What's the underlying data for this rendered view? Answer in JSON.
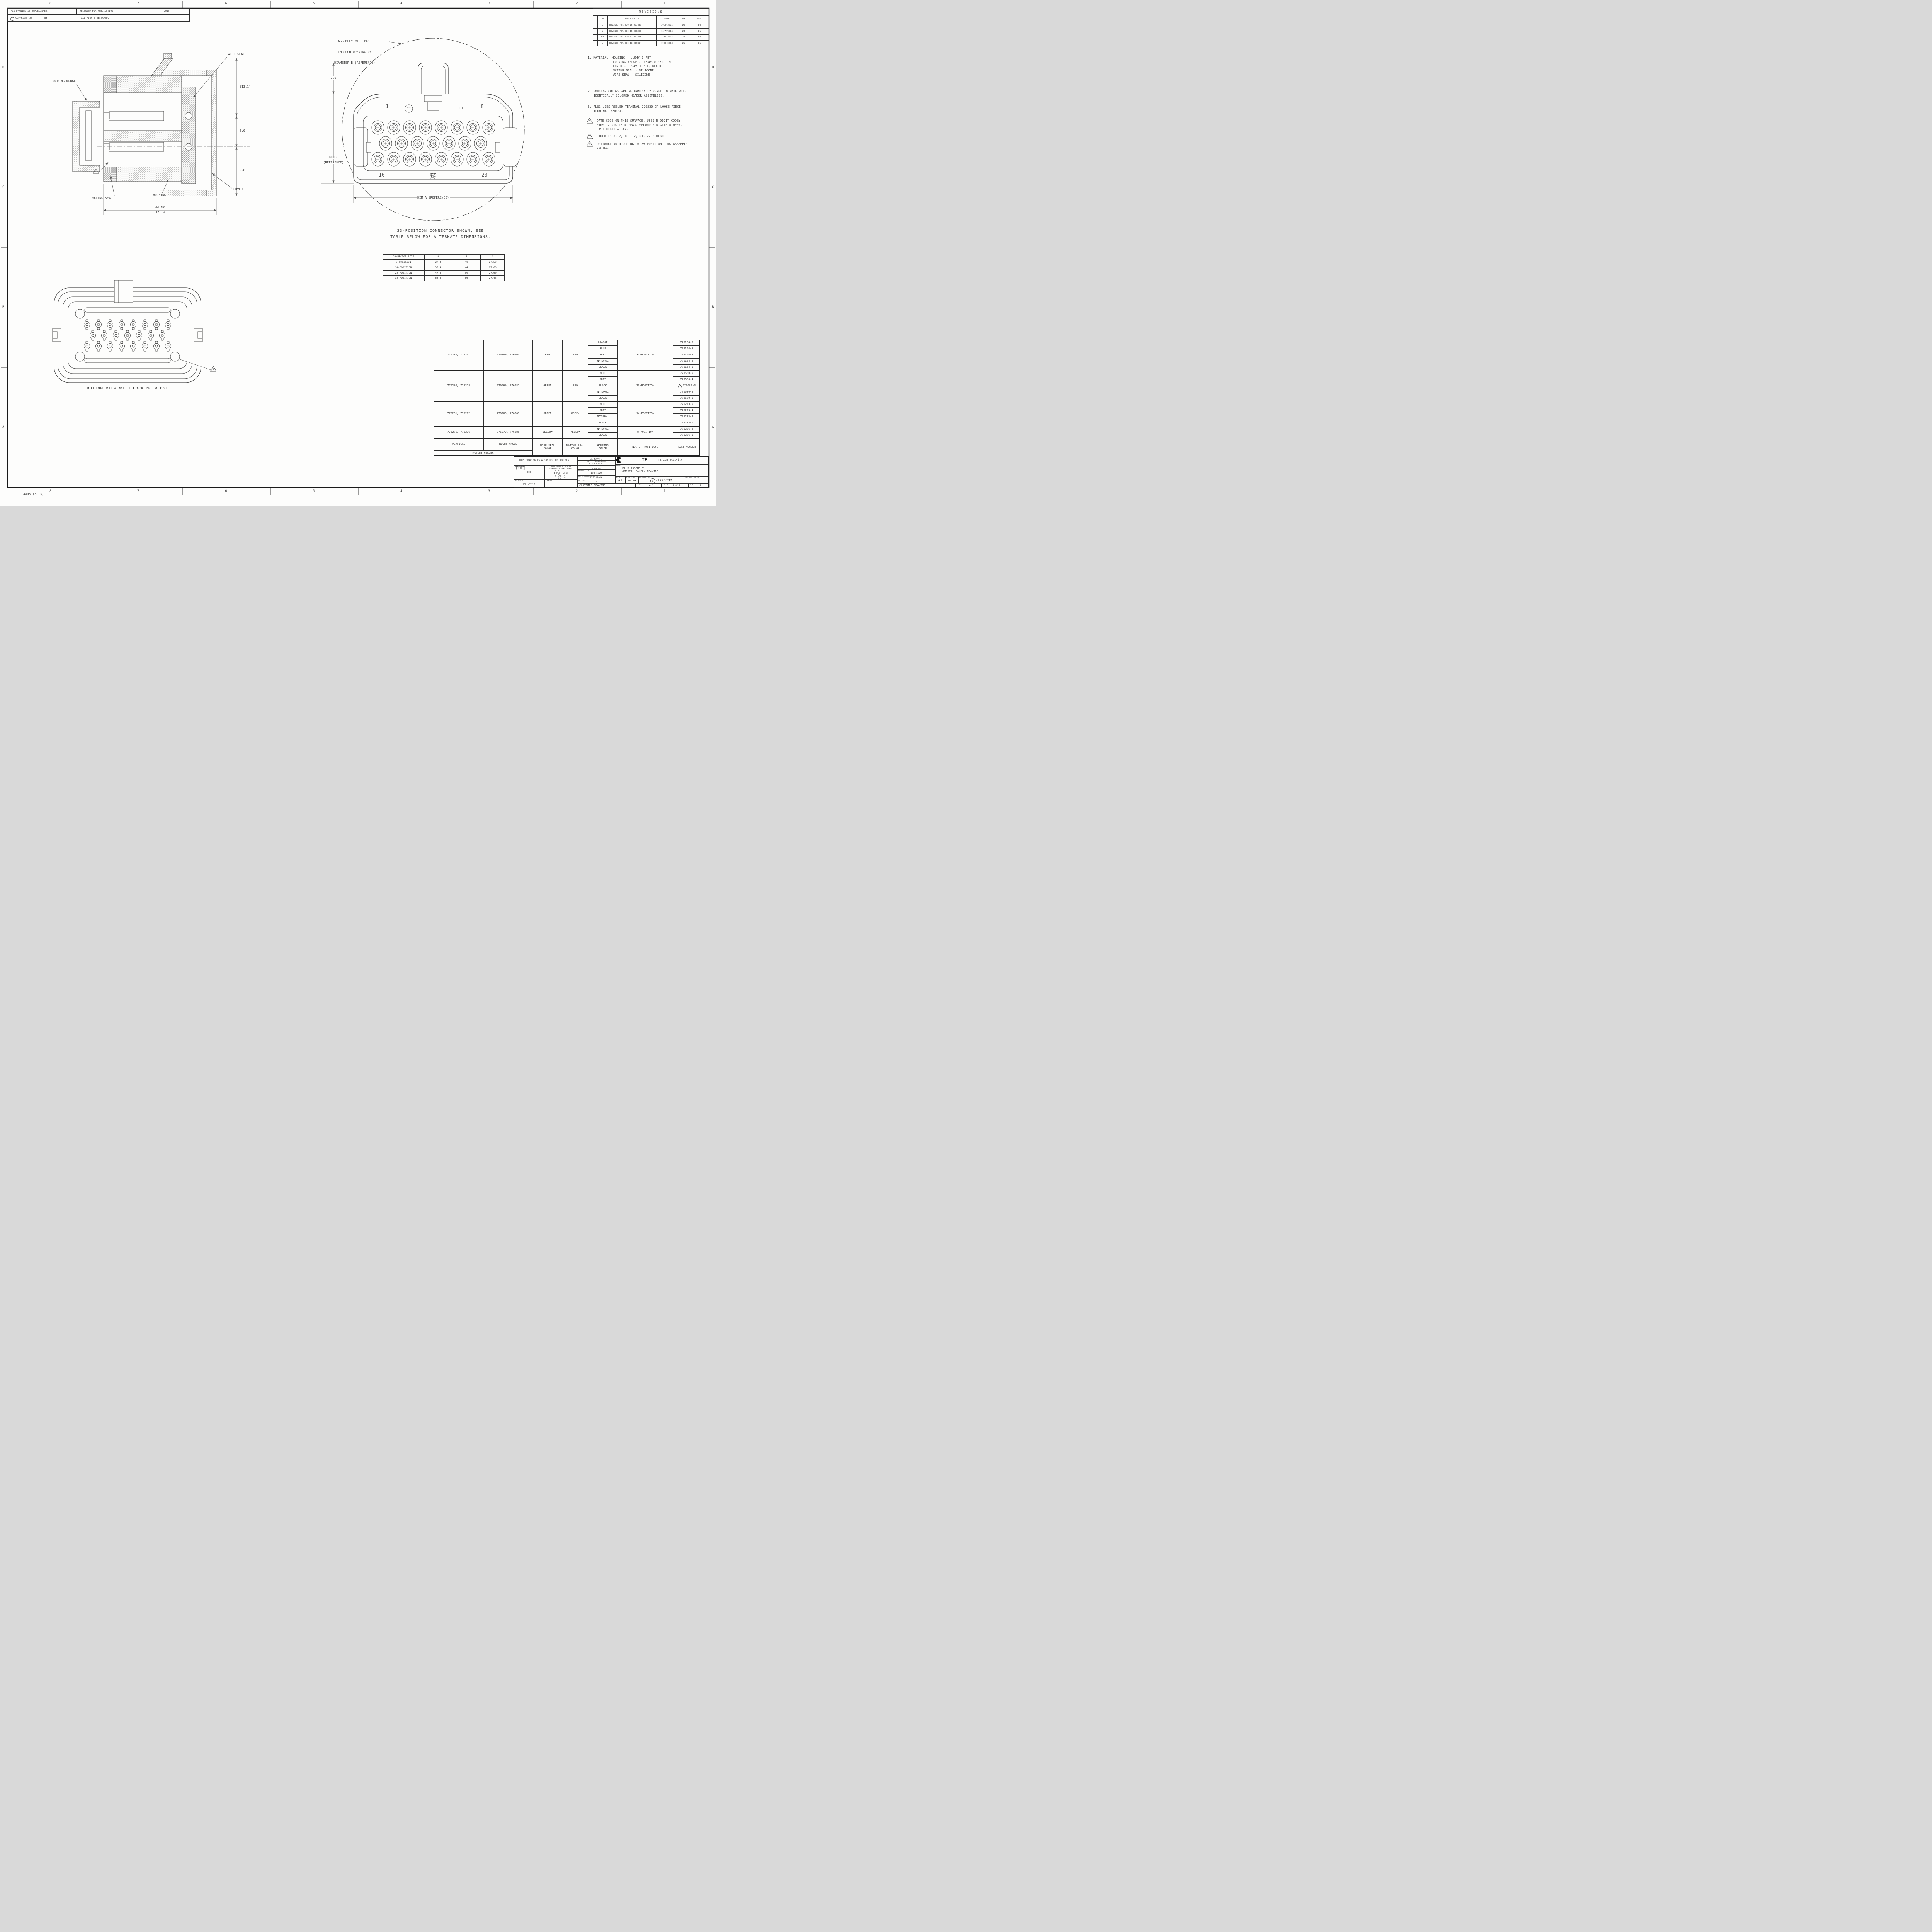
{
  "sheet": {
    "zones_top": [
      "8",
      "7",
      "6",
      "5",
      "4",
      "3",
      "2",
      "1"
    ],
    "zones_bottom": [
      "8",
      "7",
      "6",
      "5",
      "4",
      "3",
      "2",
      "1"
    ],
    "zones_left": [
      "D",
      "C",
      "B",
      "A"
    ],
    "zones_right": [
      "D",
      "C",
      "B",
      "A"
    ],
    "corner_note": "4805 (3/13)"
  },
  "header": {
    "unpublished": "THIS DRAWING IS UNPUBLISHED.",
    "released": "RELEASED FOR PUBLICATION",
    "year": "2015",
    "copyright_symbol": "C",
    "copyright": "COPYRIGHT 20",
    "by": "BY -",
    "rights": "ALL RIGHTS RESERVED."
  },
  "revisions": {
    "title": "REVISIONS",
    "headers": {
      "ltr": "LTR",
      "description": "DESCRIPTION",
      "date": "DATE",
      "dwn": "DWN",
      "apvd": "APVD"
    },
    "rows": [
      {
        "ltr": "C",
        "description": "REVISED PER ECO-15-017333",
        "date": "29DEC2015",
        "dwn": "DD",
        "apvd": "DS"
      },
      {
        "ltr": "D",
        "description": "REVISED PER ECO-16-006990",
        "date": "16MAY2016",
        "dwn": "DD",
        "apvd": "DS"
      },
      {
        "ltr": "D1",
        "description": "REVISED PER ECO-17-007878",
        "date": "31MAY2017",
        "dwn": "JM",
        "apvd": "DS"
      },
      {
        "ltr": "E",
        "description": "REVISED PER ECO-18-019884",
        "date": "19DEC2018",
        "dwn": "DS",
        "apvd": "DS"
      }
    ]
  },
  "notes": {
    "items": [
      {
        "lines": [
          "1. MATERIAL: HOUSING - UL94V-0 PBT",
          "LOCKING WEDGE - UL94V-0 PBT, RED",
          "COVER - UL94V-0 PBT, BLACK",
          "MATING SEAL - SILICONE",
          "WIRE SEAL - SILICONE"
        ]
      },
      {
        "lines": [
          "2. HOUSING COLORS ARE MECHANICALLY KEYED TO MATE WITH",
          "IDENTICALLY COLORED HEADER ASSEMBLIES."
        ]
      },
      {
        "lines": [
          "3. PLUG USES REELED TERMINAL 770520 OR LOOSE PIECE",
          "TERMINAL 770854."
        ]
      },
      {
        "marker": "4",
        "lines": [
          "DATE CODE ON THIS SURFACE. USES 5 DIGIT CODE:",
          "FIRST 2 DIGITS = YEAR, SECOND 2 DIGITS = WEEK,",
          "LAST DIGIT = DAY."
        ]
      },
      {
        "marker": "5",
        "lines": [
          "CIRCUITS 3, 7, 16, 17, 21, 22 BLOCKED"
        ]
      },
      {
        "marker": "6",
        "lines": [
          "OPTIONAL VOID CORING ON 35 POSITION PLUG ASSEMBLY",
          "776164."
        ]
      }
    ]
  },
  "section_view": {
    "labels": {
      "locking_wedge": "LOCKING WEDGE",
      "wire_seal": "WIRE SEAL",
      "mating_seal": "MATING SEAL",
      "housing": "HOUSING",
      "cover": "COVER",
      "note_marker": "4"
    },
    "dims": {
      "d131": "(13.1)",
      "d80": "8.0",
      "d98": "9.8",
      "d3360": "33.60",
      "d3210": "32.10"
    }
  },
  "front_view": {
    "assembly_note": [
      "ASSEMBLY WILL PASS",
      "THROUGH OPENING OF",
      "DIAMETER B (REFERENCE)"
    ],
    "dims": {
      "d70": "7.0",
      "dimc_l1": "DIM C",
      "dimc_l2": "(REFERENCE)",
      "dima": "DIM A (REFERENCE)"
    },
    "pins": {
      "p1": "1",
      "p8": "8",
      "p16": "16",
      "p23": "23"
    },
    "icons": {
      "csa": "CSA",
      "ul": "UL",
      "te": "TE"
    }
  },
  "bottom_view": {
    "caption": "BOTTOM VIEW WITH LOCKING WEDGE",
    "note_marker": "6"
  },
  "caption": {
    "line1": "23-POSITION CONNECTOR SHOWN, SEE",
    "line2": "TABLE BELOW FOR ALTERNATE DIMENSIONS."
  },
  "size_table": {
    "headers": [
      "CONNECTOR SIZE",
      "A",
      "B",
      "C"
    ],
    "rows": [
      [
        "8-POSITION",
        "27.4",
        "40",
        "27.50"
      ],
      [
        "14-POSITION",
        "35.4",
        "44",
        "27.60"
      ],
      [
        "23-POSITION",
        "47.4",
        "50",
        "27.60"
      ],
      [
        "35-POSITION",
        "63.4",
        "66",
        "27.45"
      ]
    ]
  },
  "parts": {
    "groups": [
      {
        "vertical": "776230, 776231",
        "right_angle": "776180, 776163",
        "wire_seal": "RED",
        "mating_seal": "RED",
        "positions": "35-POSITION",
        "rows": [
          {
            "housing": "ORANGE",
            "part": "776164-6"
          },
          {
            "housing": "BLUE",
            "part": "776164-5"
          },
          {
            "housing": "GREY",
            "part": "776164-4"
          },
          {
            "housing": "NATURAL",
            "part": "776164-2"
          },
          {
            "housing": "BLACK",
            "part": "776164-1"
          }
        ]
      },
      {
        "vertical": "776200, 776228",
        "right_angle": "770669, 776087",
        "wire_seal": "GREEN",
        "mating_seal": "RED",
        "positions": "23-POSITION",
        "rows": [
          {
            "housing": "BLUE",
            "part": "770680-5"
          },
          {
            "housing": "GREY",
            "part": "770680-4"
          },
          {
            "housing": "BLACK",
            "part": "770680-3",
            "note": "5"
          },
          {
            "housing": "NATURAL",
            "part": "770680-2"
          },
          {
            "housing": "BLACK",
            "part": "770680-1"
          }
        ]
      },
      {
        "vertical": "776261, 776262",
        "right_angle": "776266, 776267",
        "wire_seal": "GREEN",
        "mating_seal": "GREEN",
        "positions": "14-POSITION",
        "rows": [
          {
            "housing": "BLUE",
            "part": "776273-5"
          },
          {
            "housing": "GREY",
            "part": "776273-4"
          },
          {
            "housing": "NATURAL",
            "part": "776273-2"
          },
          {
            "housing": "BLACK",
            "part": "776273-1"
          }
        ]
      },
      {
        "vertical": "776275, 776276",
        "right_angle": "776279, 776280",
        "wire_seal": "YELLOW",
        "mating_seal": "YELLOW",
        "positions": "8-POSITION",
        "rows": [
          {
            "housing": "NATURAL",
            "part": "776286-2"
          },
          {
            "housing": "BLACK",
            "part": "776286-1"
          }
        ]
      }
    ],
    "footer": {
      "vertical": "VERTICAL",
      "right_angle": "RIGHT-ANGLE",
      "wire_l1": "WIRE SEAL",
      "wire_l2": "COLOR",
      "mating_l1": "MATING SEAL",
      "mating_l2": "COLOR",
      "housing_l1": "HOUSING",
      "housing_l2": "COLOR",
      "positions": "NO. OF POSITIONS",
      "part": "PART NUMBER",
      "mating_header": "MATING HEADER"
    }
  },
  "title_block": {
    "controlled": "THIS DRAWING IS A CONTROLLED DOCUMENT.",
    "dimensions_label": "DIMENSIONS:",
    "units": "mm",
    "tol_title_l1": "TOLERANCES UNLESS",
    "tol_title_l2": "OTHERWISE SPECIFIED:",
    "tol": [
      {
        "l": "0 PLC",
        "v": "±-"
      },
      {
        "l": "1 PLC",
        "v": "±0.2"
      },
      {
        "l": "2 PLC",
        "v": "±-"
      },
      {
        "l": "3 PLC",
        "v": "±-"
      },
      {
        "l": "4 PLC",
        "v": "±-"
      },
      {
        "l": "ANGLES",
        "v": "±-"
      }
    ],
    "material_label": "MATERIAL",
    "material_value": "-",
    "material_note": "SEE NOTE 1",
    "finish_label": "FINISH",
    "finish_value": "-",
    "dwn_label": "DWN",
    "dwn_date": "11JUN2015",
    "dwn_name": "A. MARTIN",
    "chk_label": "CHK",
    "chk_date": "29JUN2015",
    "chk_name": "D STRAUSSER",
    "apvd_label": "APVD",
    "apvd_date": "29JUN2015",
    "apvd_name": "G BROWN",
    "product_spec_label": "PRODUCT SPEC",
    "product_spec": "108-1329",
    "application_spec_label": "APPLICATION SPEC",
    "application_spec": "114-16016",
    "weight_label": "WEIGHT",
    "weight_value": "-",
    "logo_text": "TE",
    "company": "TE Connectivity",
    "name_label": "NAME",
    "name_l1": "PLUG ASSEMBLY,",
    "name_l2": "AMPSEAL FAMILY DRAWING",
    "name_l3": "-",
    "size_label": "SIZE",
    "size_value": "A1",
    "cage_label": "CAGE CODE",
    "cage_value": "00779",
    "drawing_no_label": "DRAWING NO",
    "drawing_prefix": "C",
    "drawing_no": "-2293782",
    "restricted_label": "RESTRICTED TO",
    "restricted_value": "-",
    "customer": "CUSTOMER DRAWING",
    "scale_label": "SCALE",
    "scale_value": "4:1",
    "sheet_label": "SHEET",
    "sheet_num": "1",
    "sheet_of": "OF",
    "sheet_total": "2",
    "rev_label": "REV",
    "rev_value": "E"
  }
}
